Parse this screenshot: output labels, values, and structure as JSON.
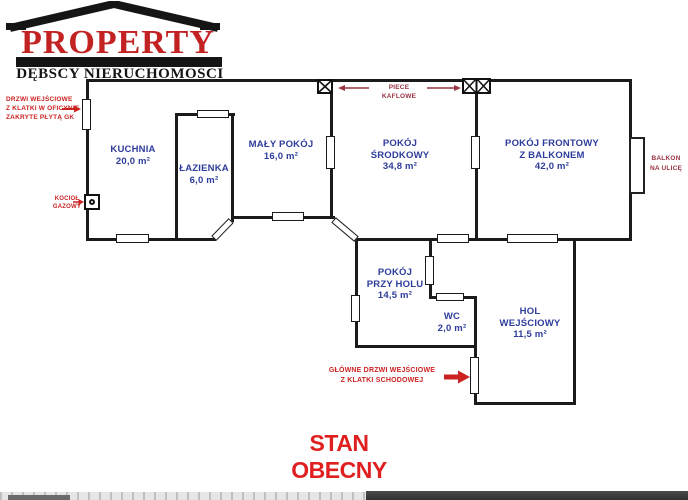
{
  "logo": {
    "brand": "PROPERTY",
    "subtitle": "DĘBSCY NIERUCHOMOŚCI"
  },
  "title": "STAN OBECNY",
  "rooms": {
    "kuchnia": {
      "line1": "KUCHNIA",
      "area": "20,0 m²"
    },
    "lazienka": {
      "line1": "ŁAZIENKA",
      "area": "6,0 m²"
    },
    "maly_pokoj": {
      "line1": "MAŁY POKÓJ",
      "area": "16,0 m²"
    },
    "pokoj_srodkowy": {
      "line1": "POKÓJ",
      "line2": "ŚRODKOWY",
      "area": "34,8 m²"
    },
    "pokoj_frontowy": {
      "line1": "POKÓJ FRONTOWY",
      "line2": "Z BALKONEM",
      "area": "42,0 m²"
    },
    "pokoj_przy_holu": {
      "line1": "POKÓJ",
      "line2": "PRZY HOLU",
      "area": "14,5 m²"
    },
    "wc": {
      "line1": "WC",
      "area": "2,0 m²"
    },
    "hol": {
      "line1": "HOL",
      "line2": "WEJŚCIOWY",
      "area": "11,5 m²"
    }
  },
  "annotations": {
    "side_entrance": {
      "line1": "DRZWI WEJŚCIOWE",
      "line2": "Z KLATKI W OFICYNIE",
      "line3": "ZAKRYTE PŁYTĄ GK"
    },
    "boiler": {
      "line1": "KOCIOŁ",
      "line2": "GAZOWY"
    },
    "stoves": "PIECE KAFLOWE",
    "balcony": {
      "line1": "BALKON",
      "line2": "NA ULICĘ"
    },
    "main_entrance": {
      "line1": "GŁÓWNE DRZWI WEJŚCIOWE",
      "line2": "Z KLATKI SCHODOWEJ"
    }
  },
  "colors": {
    "wall": "#1b1b1b",
    "room_label": "#2e3d9b",
    "annotation_red": "#cc2222",
    "annotation_maroon": "#9a3344",
    "title_red": "#e02020",
    "brand_red": "#c32222"
  }
}
